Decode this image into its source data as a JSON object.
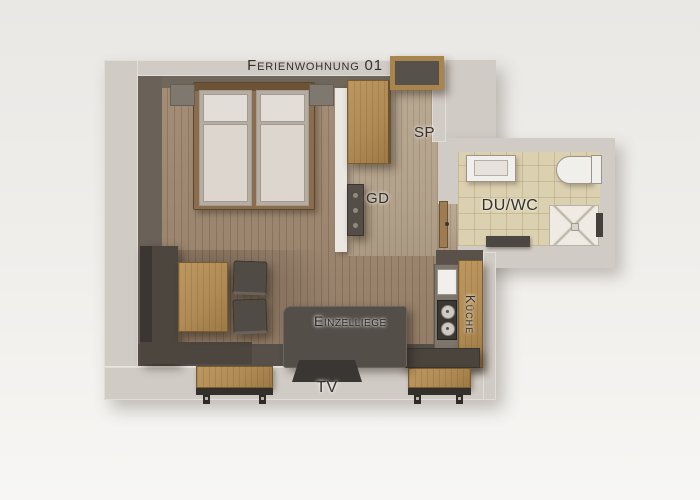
{
  "title": "Ferienwohnung 01",
  "labels": {
    "closet": "SP",
    "coatrack": "GD",
    "bathroom": "DU/WC",
    "kitchen": "Küche",
    "daybed": "Einzelliege",
    "tv": "TV"
  },
  "colors": {
    "background": "#f0eeeb",
    "wall_light": "#d1cbc5",
    "wall_dark": "#6a6158",
    "divider_wall": "#eae6e1",
    "floor_wood": "#9c8670",
    "hall_wood": "#b3a28c",
    "bath_tile": "#dbd0af",
    "oak": "#b08b55",
    "dark_furniture": "#514b45",
    "mattress": "#dcd6ce",
    "fixture_white": "#f1efeb",
    "label_text": "#35312d"
  }
}
